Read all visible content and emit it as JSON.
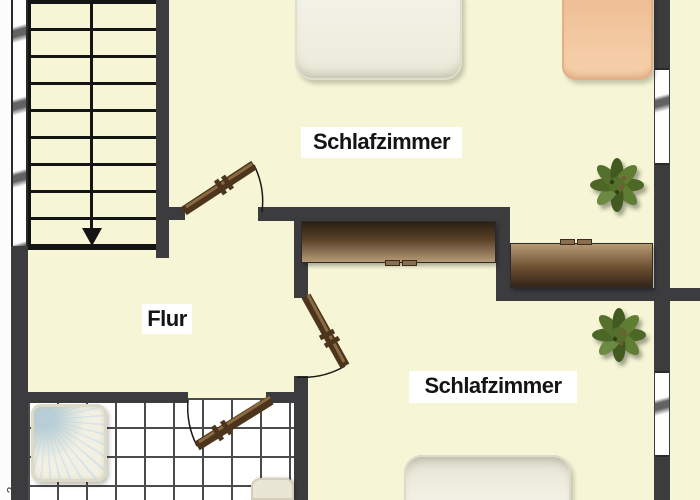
{
  "plan": {
    "type": "floor-plan",
    "labels": {
      "room_top": "Schlafzimmer",
      "room_hall": "Flur",
      "room_bottom": "Schlafzimmer",
      "corner_mark": "2"
    },
    "rooms": [
      {
        "id": "schlafzimmer-top",
        "label": "Schlafzimmer",
        "furniture": [
          "bed",
          "bed",
          "wardrobe",
          "plant"
        ]
      },
      {
        "id": "flur",
        "label": "Flur",
        "furniture": [
          "staircase"
        ]
      },
      {
        "id": "schlafzimmer-bottom",
        "label": "Schlafzimmer",
        "furniture": [
          "wardrobe",
          "plant",
          "bed"
        ]
      },
      {
        "id": "bathroom",
        "label": "",
        "furniture": [
          "shower",
          "toilet"
        ]
      }
    ],
    "elements": {
      "doors": 3,
      "windows": 3,
      "staircase_direction": "down"
    },
    "colors": {
      "floor": "#f6f6d6",
      "wall": "#3c3c3e",
      "door_wood": "#4c351c",
      "stair_lines": "#141414",
      "tile_line": "#4b4b4b",
      "wardrobe_dark": "#2c1f11",
      "wardrobe_light": "#b79b77",
      "bed_white": "#f0efe2",
      "bed_peach": "#f2c8a0",
      "plant_green": "#55702c"
    }
  }
}
